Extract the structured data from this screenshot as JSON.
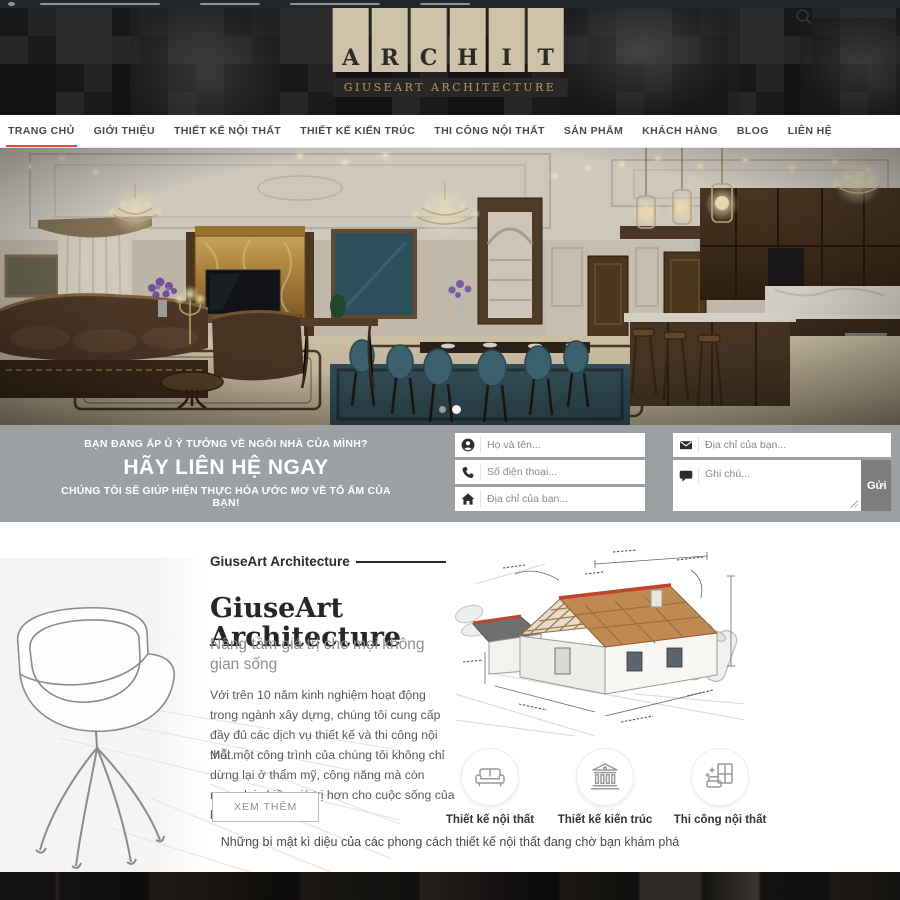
{
  "header": {
    "logo_letters": [
      "A",
      "R",
      "C",
      "H",
      "I",
      "T"
    ],
    "logo_subtitle": "GIUSEART ARCHITECTURE"
  },
  "nav": {
    "items": [
      {
        "label": "TRANG CHỦ",
        "active": true
      },
      {
        "label": "GIỚI THIỆU",
        "active": false
      },
      {
        "label": "THIẾT KẾ NỘI THẤT",
        "active": false
      },
      {
        "label": "THIẾT KẾ KIẾN TRÚC",
        "active": false
      },
      {
        "label": "THI CÔNG NỘI THẤT",
        "active": false
      },
      {
        "label": "SẢN PHẨM",
        "active": false
      },
      {
        "label": "KHÁCH HÀNG",
        "active": false
      },
      {
        "label": "BLOG",
        "active": false
      },
      {
        "label": "LIÊN HỆ",
        "active": false
      }
    ]
  },
  "hero": {
    "dots": [
      {
        "active": false
      },
      {
        "active": true
      }
    ]
  },
  "cta": {
    "line1": "BẠN ĐANG ẤP Ủ Ý TƯỞNG VỀ NGÔI NHÀ CỦA MÌNH?",
    "line2": "HÃY LIÊN HỆ NGAY",
    "line3": "CHÚNG TÔI SẼ GIÚP HIỆN THỰC HÓA ƯỚC MƠ VỀ TỔ ẤM CỦA BẠN!",
    "form": {
      "fields": [
        {
          "placeholder": "Họ và tên...",
          "icon": "user-icon"
        },
        {
          "placeholder": "Số điện thoại...",
          "icon": "phone-icon"
        },
        {
          "placeholder": "Địa chỉ của bạn...",
          "icon": "home-icon"
        },
        {
          "placeholder": "Địa chỉ của bạn...",
          "icon": "mail-icon"
        },
        {
          "placeholder": "Ghi chú...",
          "icon": "comment-icon"
        }
      ],
      "submit_label": "Gửi"
    }
  },
  "about": {
    "eyebrow": "GiuseArt Architecture",
    "title_line1": "GiuseArt",
    "title_line2": "Architecture",
    "subtitle": "Nâng tầm giá trị cho mọi không gian sống",
    "paragraph1": "Với trên 10 năm kinh nghiệm hoạt động trong ngành xây dựng, chúng tôi cung cấp đầy đủ các dịch vụ thiết kế và thi công nội thất.",
    "paragraph2": "Mỗi một công trình của chúng tôi không chỉ dừng lại ở thẩm mỹ, công năng mà còn mang lại nhiều giá trị hơn cho cuộc sống của bạn",
    "button": "XEM THÊM"
  },
  "services": [
    {
      "label": "Thiết kế nội thất",
      "icon": "sofa-icon"
    },
    {
      "label": "Thiết kế kiến trúc",
      "icon": "building-icon"
    },
    {
      "label": "Thi công nội thất",
      "icon": "furniture-icon"
    }
  ],
  "closing_text": "Những bí mật kì diệu của các phong cách thiết kế nội thất đang chờ bạn khám phá",
  "colors": {
    "accent_red": "#e0473d",
    "logo_beige": "#cec3a8",
    "logo_gold": "#b6965a",
    "cta_background": "#9ca0a3",
    "submit_gray": "#7d7d7d"
  }
}
